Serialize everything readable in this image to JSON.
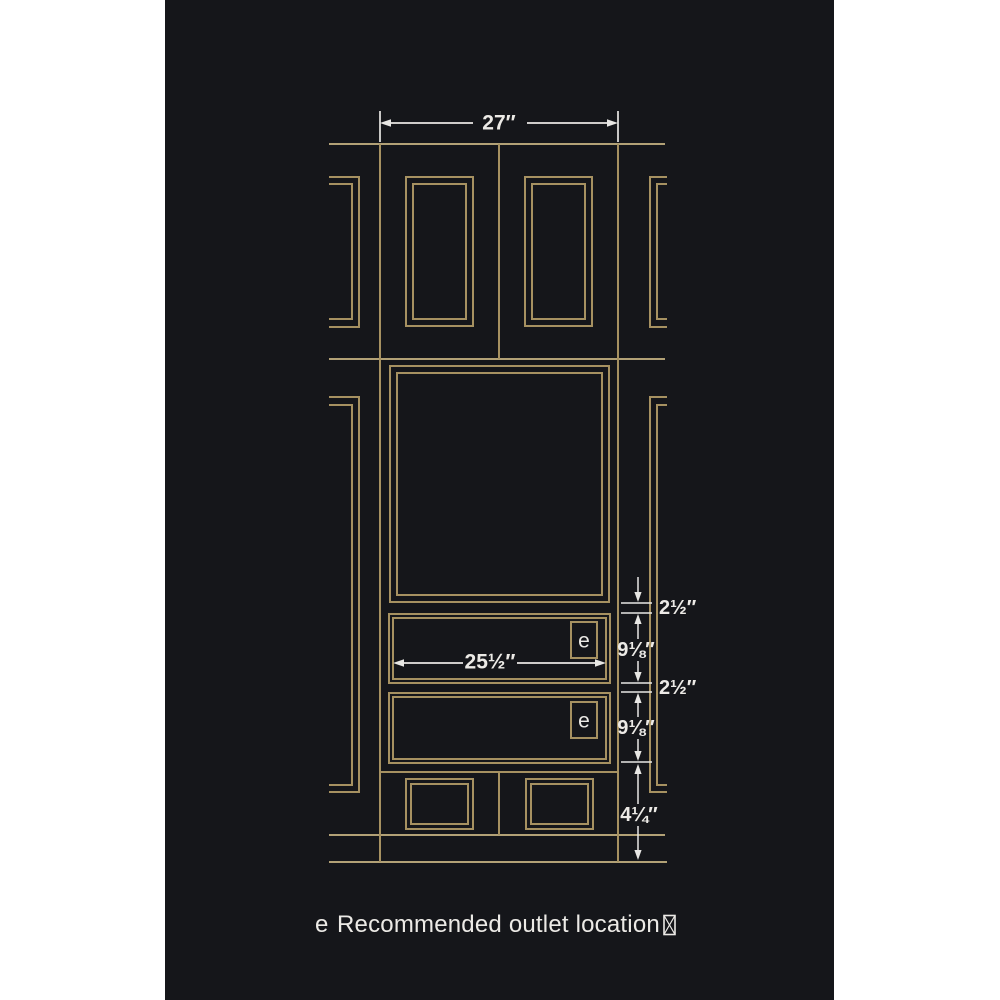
{
  "page": {
    "background": "#ffffff"
  },
  "drawing": {
    "background": "#15161a",
    "gold_line_color": "#a69161",
    "white_line_color": "#e8e7e4",
    "dims": {
      "cabinet_width": "27″",
      "drawer_opening_width": "25½″",
      "gap_top": "2½″",
      "drawer_1_height": "9⅛″",
      "gap_middle": "2½″",
      "drawer_2_height": "9⅛″",
      "toe_kick_height": "4¼″"
    },
    "outlet_markers": {
      "upper": "e",
      "lower": "e"
    }
  },
  "legend": {
    "marker": "e",
    "label": "Recommended outlet location"
  }
}
